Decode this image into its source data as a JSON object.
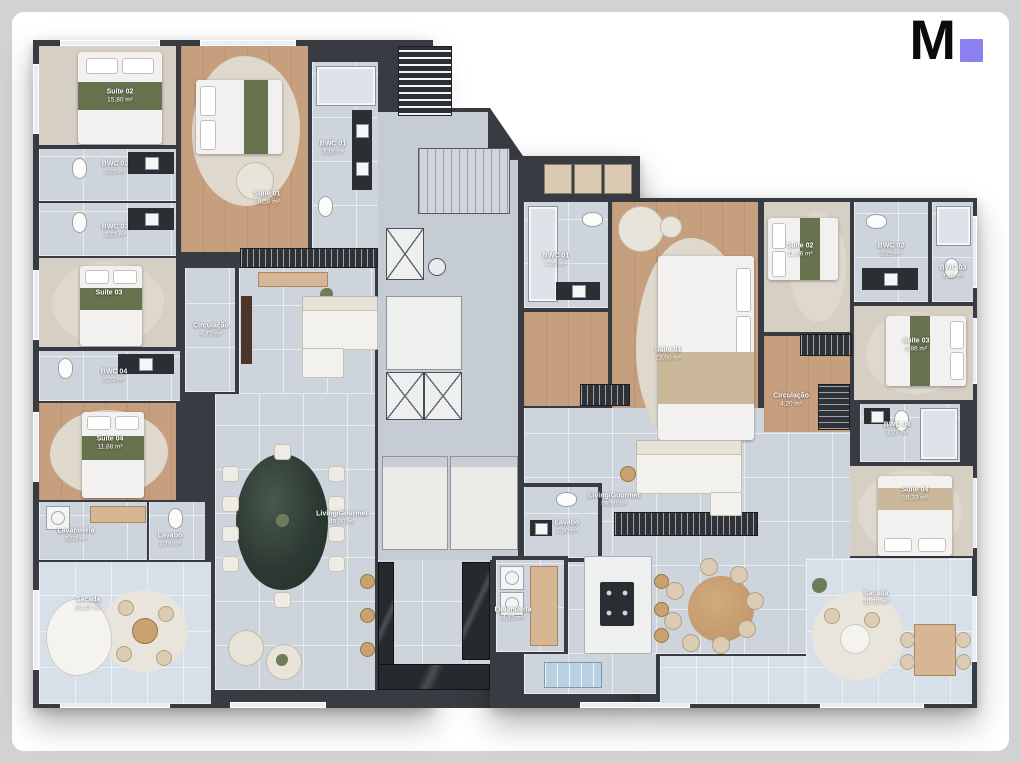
{
  "logo": {
    "letter": "M",
    "square_style": "background:#8b80f2"
  },
  "colors": {
    "page_background": "#d2d2d2",
    "card_background": "#ffffff",
    "wall": "#383c42",
    "wood_floor": "#c69f7e",
    "tile_floor": "#cdd4dc",
    "balcony_floor": "#d7dfe9",
    "bed_accent_green": "#67724f",
    "logo_square": "#8b80f2"
  },
  "rooms": {
    "left": {
      "suite01": {
        "name": "Suite 01",
        "area": "18,56 m²"
      },
      "suite02": {
        "name": "Suite 02",
        "area": "15,80 m²"
      },
      "suite03": {
        "name": "Suite 03",
        "area": ""
      },
      "suite04": {
        "name": "Suite 04",
        "area": "11,88 m²"
      },
      "bwc01": {
        "name": "BWC 01",
        "area": "3,16 m²"
      },
      "bwc02": {
        "name": "BWC 02",
        "area": "3,20 m²"
      },
      "bwc03": {
        "name": "BWC 03",
        "area": "3,23 m²"
      },
      "bwc04": {
        "name": "BWC 04",
        "area": "3,23 m²"
      },
      "circulacao": {
        "name": "Circulação",
        "area": "4,73 m²"
      },
      "living": {
        "name": "Living/Gourmet",
        "area": "49,80 m²"
      },
      "lavanderia": {
        "name": "Lavanderia",
        "area": "5,03 m²"
      },
      "lavabo": {
        "name": "Lavabo",
        "area": "1,78 m²"
      },
      "sacada": {
        "name": "Sacada",
        "area": "10,47 m²"
      }
    },
    "right": {
      "suite01": {
        "name": "Suite 01",
        "area": "23,90 m²"
      },
      "suite02": {
        "name": "Suite 02",
        "area": "11,96 m²"
      },
      "suite03": {
        "name": "Suite 03",
        "area": "9,86 m²"
      },
      "suite04": {
        "name": "Suite 04",
        "area": "16,33 m²"
      },
      "bwc01": {
        "name": "BWC 01",
        "area": "4,35 m²"
      },
      "bwc02": {
        "name": "BWC 02",
        "area": "3,25 m²"
      },
      "bwc03": {
        "name": "BWC 03",
        "area": "3,18 m²"
      },
      "bwc04": {
        "name": "BWC 04",
        "area": "3,27 m²"
      },
      "circulacao": {
        "name": "Circulação",
        "area": "4,20 m²"
      },
      "living": {
        "name": "Living/Gourmet",
        "area": "56,50 m²"
      },
      "lavabo": {
        "name": "Lavabo",
        "area": "1,90 m²"
      },
      "lavanderia": {
        "name": "Lavanderia",
        "area": "4,72 m²"
      },
      "sacada": {
        "name": "Sacada",
        "area": "10,78 m²"
      }
    }
  }
}
